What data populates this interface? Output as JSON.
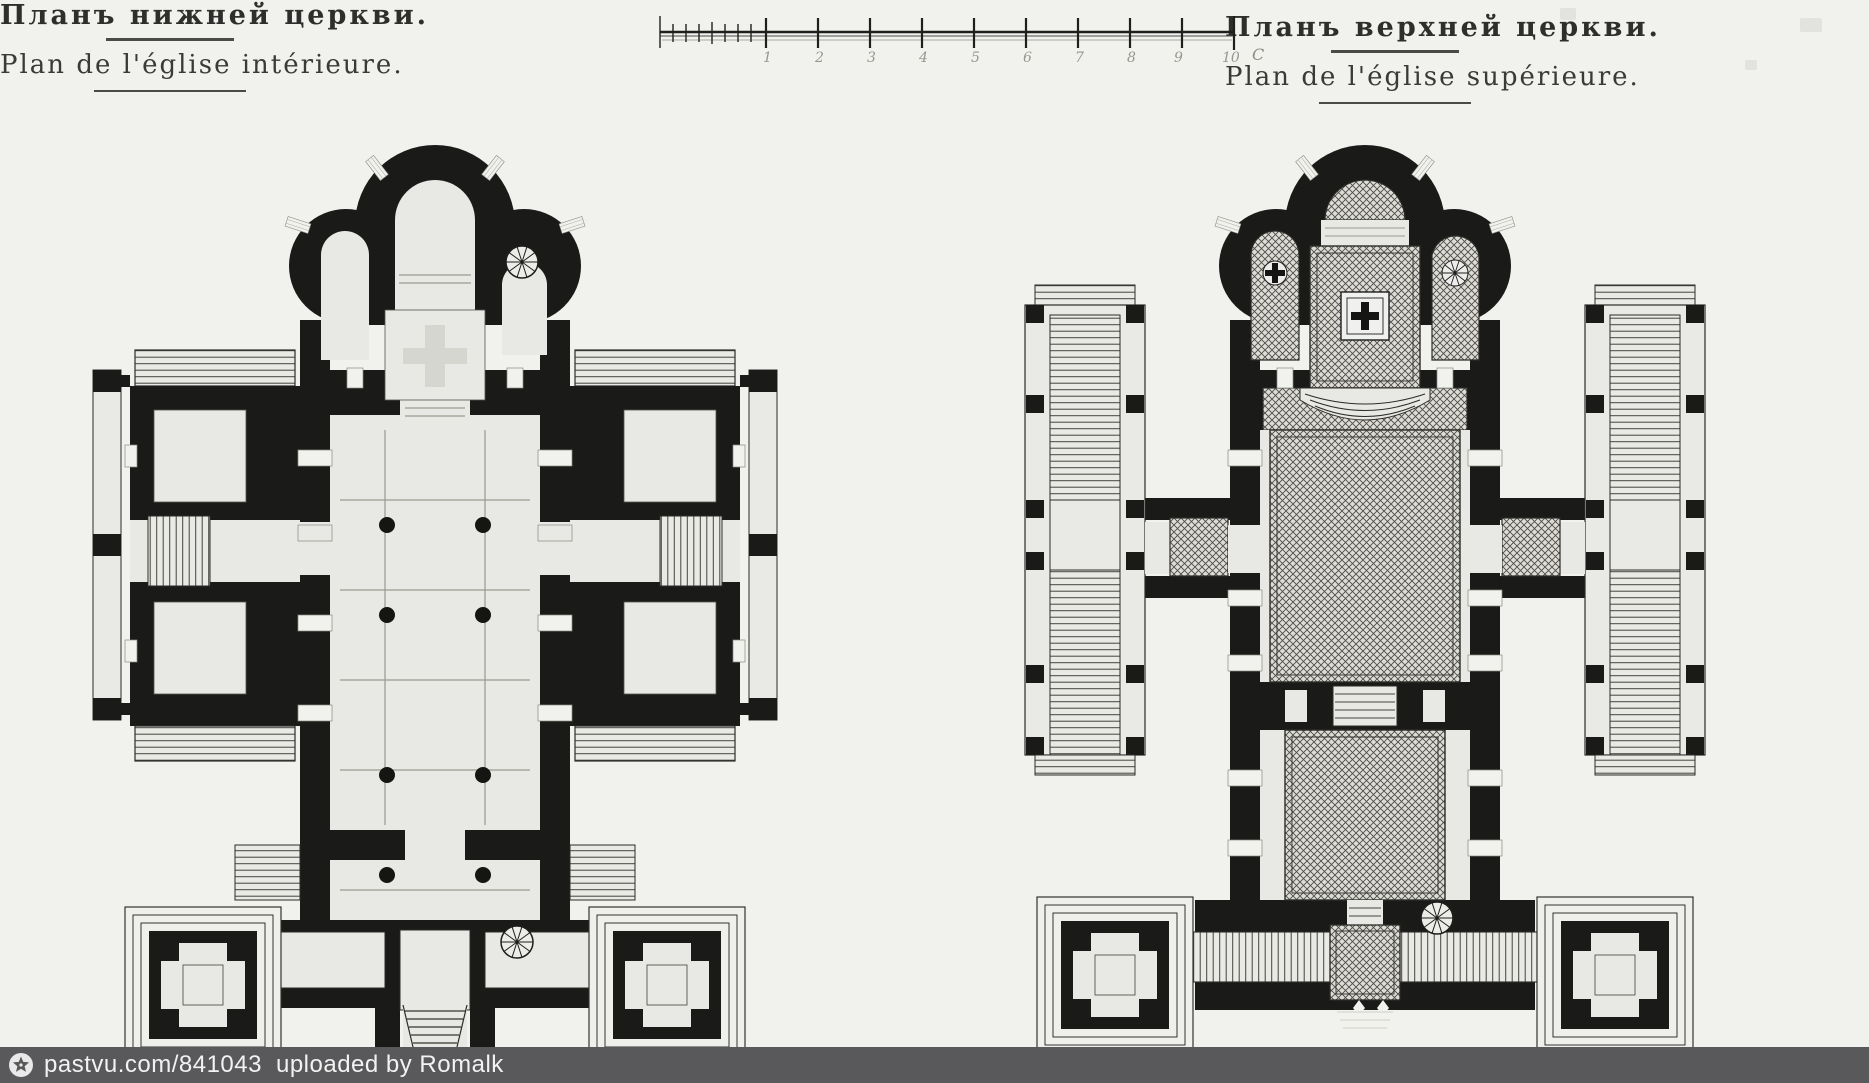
{
  "page": {
    "background": "#f1f1ee",
    "kind": "scanned architectural drawing, two church floor plans"
  },
  "titles": {
    "left": {
      "ru": "Планъ нижней церкви.",
      "fr": "Plan de l'église intérieure."
    },
    "right": {
      "ru": "Планъ верхней церкви.",
      "fr": "Plan de l'église supérieure."
    }
  },
  "scale_bar": {
    "tick_labels": [
      "1",
      "2",
      "3",
      "4",
      "5",
      "6",
      "7",
      "8",
      "9",
      "10"
    ],
    "unit": "С"
  },
  "plans": {
    "left": {
      "id": "lower-church",
      "caption_ru": "Планъ нижней церкви.",
      "caption_fr": "Plan de l'église intérieure.",
      "features": [
        "trefoil-apse",
        "arched-side-chapels",
        "spiral-staircase",
        "side-wings-with-stairs",
        "nave-columns",
        "entrance-gallery",
        "corner-pavilions",
        "porch-steps"
      ]
    },
    "right": {
      "id": "upper-church",
      "caption_ru": "Планъ верхней церкви.",
      "caption_fr": "Plan de l'église supérieure.",
      "features": [
        "trefoil-apse",
        "cross-hatched-floors",
        "altar-cross-emblem",
        "chapel-cross-emblem",
        "fan-window",
        "stair-galleries",
        "stepped-walkways",
        "spiral-staircase",
        "corner-pavilions"
      ]
    }
  },
  "watermark": {
    "site": "pastvu.com/841043",
    "credit": "uploaded by Romalk",
    "icon": "star-circle-icon",
    "bg": "#59595b",
    "fg": "#f2f2f2"
  },
  "colors": {
    "paper": "#f1f1ee",
    "wall_ink": "#1a1a18",
    "room": "#e8e8e4",
    "hatch_line": "#4e4c46",
    "bar_bg": "#59595b"
  }
}
